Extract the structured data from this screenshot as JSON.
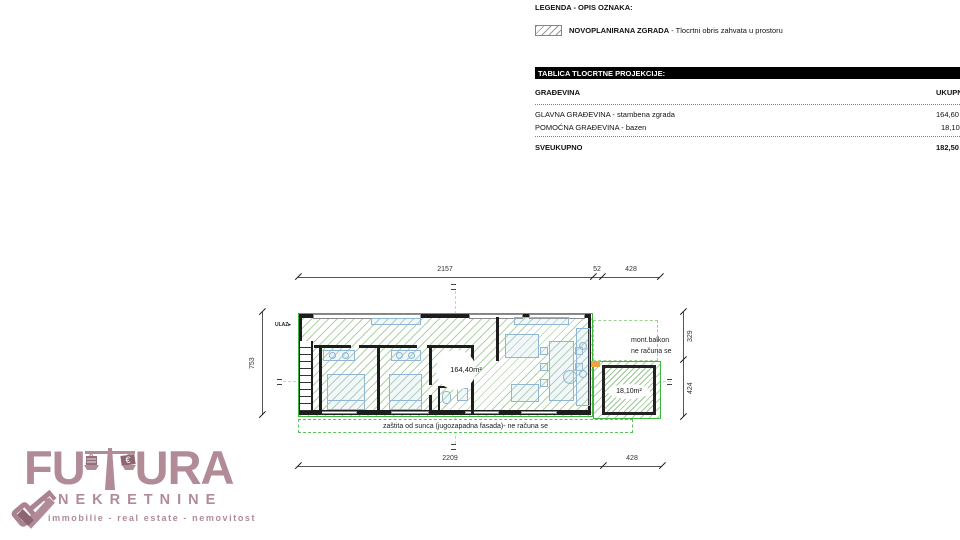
{
  "legend": {
    "title": "LEGENDA - OPIS OZNAKA:",
    "item_name": "NOVOPLANIRANA ZGRADA",
    "item_desc": "- Tlocrtni obris zahvata u prostoru"
  },
  "table": {
    "title": "TABLICA TLOCRTNE PROJEKCIJE:",
    "col_building": "GRAĐEVINA",
    "col_total": "UKUPNO",
    "rows": [
      {
        "label": "GLAVNA GRAĐEVINA - stambena zgrada",
        "value": "164,60"
      },
      {
        "label": "POMOĆNA GRAĐEVINA - bazen",
        "value": "18,10"
      }
    ],
    "total_label": "SVEUKUPNO",
    "total_value": "182,50"
  },
  "plan": {
    "entrance_label": "ULAZ",
    "house_area": "164,40m²",
    "pool_area": "18,10m²",
    "balcony_note_line1": "mont.balkon",
    "balcony_note_line2": "ne računa se",
    "shade_note": "zaštita od sunca (jugozapadna fasada)- ne računa se",
    "dim_top_main": "2157",
    "dim_top_small": "52",
    "dim_top_right": "428",
    "dim_left": "753",
    "dim_right_upper": "329",
    "dim_right_lower": "424",
    "dim_bottom_main": "2209",
    "dim_bottom_right": "428",
    "colors": {
      "outline_green": "#3cb83c",
      "hatch_green": "#c3ddbc",
      "wall_dark": "#1d1d1d",
      "furniture_blue": "#8fb6d4"
    }
  },
  "logo": {
    "brand_prefix": "FU",
    "brand_suffix": "URA",
    "brand_sub": "NEKRETNINE",
    "tagline": "immobilie - real estate - nemovitost",
    "euro_symbol": "€",
    "color": "#b18c97"
  }
}
